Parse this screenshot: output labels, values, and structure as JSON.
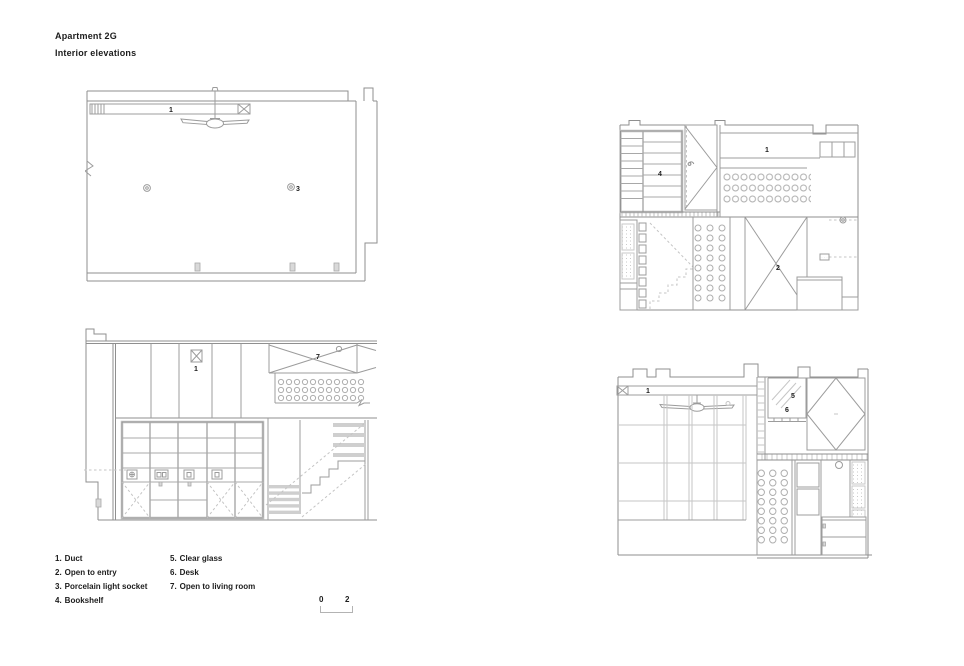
{
  "page": {
    "title": "Apartment 2G",
    "subtitle": "Interior elevations"
  },
  "legend": {
    "column1": [
      {
        "num": "1.",
        "label": "Duct"
      },
      {
        "num": "2.",
        "label": "Open to entry"
      },
      {
        "num": "3.",
        "label": "Porcelain light socket"
      },
      {
        "num": "4.",
        "label": "Bookshelf"
      }
    ],
    "column2": [
      {
        "num": "5.",
        "label": "Clear glass"
      },
      {
        "num": "6.",
        "label": "Desk"
      },
      {
        "num": "7.",
        "label": "Open to living room"
      }
    ]
  },
  "scale_bar": {
    "start": "0",
    "end": "2"
  },
  "drawings": {
    "top_left": {
      "callouts": {
        "duct": "1",
        "porcelain_light_socket": "3"
      }
    },
    "bottom_left": {
      "callouts": {
        "duct": "1",
        "open_to_living_room": "7"
      }
    },
    "top_right": {
      "callouts": {
        "bookshelf": "4",
        "duct": "1",
        "open_to_entry": "2"
      }
    },
    "bottom_right": {
      "callouts": {
        "duct": "1",
        "clear_glass": "5",
        "desk": "6"
      }
    }
  },
  "colors": {
    "line": "#9c9c9c",
    "line_dark": "#8f8f8f",
    "line_light": "#c6c6c6",
    "fill_gray": "#d9d9d9",
    "text": "#1c1c1c",
    "background": "#ffffff"
  }
}
